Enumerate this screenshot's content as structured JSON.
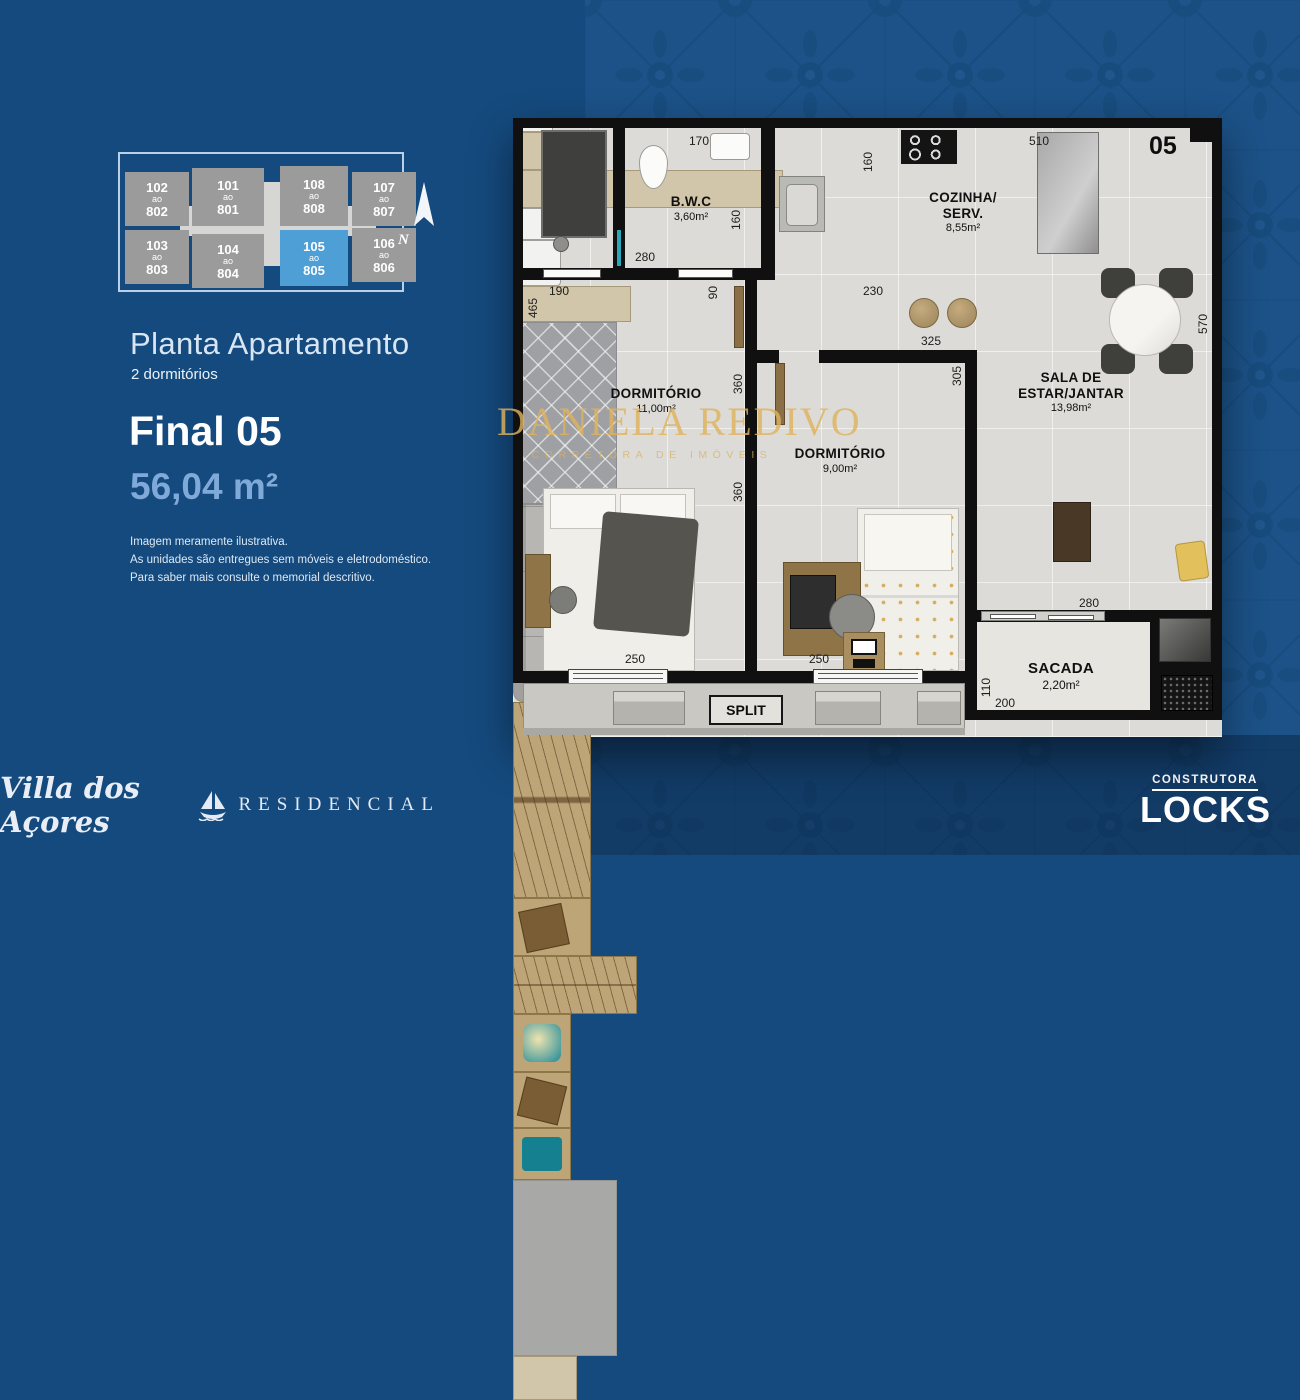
{
  "colors": {
    "left_bg": "#154a7e",
    "pattern_bg": "#1c5288",
    "keyplan_highlight": "#4f9fd7",
    "watermark_gold": "#d9a94e",
    "area_text": "#7fa9d9"
  },
  "left_panel": {
    "keyplan": {
      "units": [
        {
          "top": "102",
          "mid": "ao",
          "bot": "802"
        },
        {
          "top": "101",
          "mid": "ao",
          "bot": "801"
        },
        {
          "top": "108",
          "mid": "ao",
          "bot": "808"
        },
        {
          "top": "107",
          "mid": "ao",
          "bot": "807"
        },
        {
          "top": "103",
          "mid": "ao",
          "bot": "803"
        },
        {
          "top": "104",
          "mid": "ao",
          "bot": "804"
        },
        {
          "top": "105",
          "mid": "ao",
          "bot": "805"
        },
        {
          "top": "106",
          "mid": "ao",
          "bot": "806"
        }
      ],
      "north_label": "N"
    },
    "title": "Planta Apartamento",
    "subtitle": "2 dormitórios",
    "final_label": "Final 05",
    "area_label": "56,04 m²",
    "disclaimer": {
      "line1": "Imagem meramente ilustrativa.",
      "line2": "As unidades são entregues sem móveis e eletrodoméstico.",
      "line3": "Para saber mais consulte o memorial descritivo."
    },
    "brand": {
      "script": "Villa dos Açores",
      "residencial": "RESIDENCIAL"
    }
  },
  "plan": {
    "unit_number": "05",
    "rooms": {
      "bwc": {
        "name": "B.W.C",
        "area": "3,60m²"
      },
      "kitchen": {
        "name1": "COZINHA/",
        "name2": "SERV.",
        "area": "8,55m²"
      },
      "dorm1": {
        "name": "DORMITÓRIO",
        "area": "11,00m²"
      },
      "dorm2": {
        "name": "DORMITÓRIO",
        "area": "9,00m²"
      },
      "sala": {
        "name1": "SALA DE",
        "name2": "ESTAR/JANTAR",
        "area": "13,98m²"
      },
      "sacada": {
        "name": "SACADA",
        "area": "2,20m²"
      }
    },
    "dims": {
      "bwc_top": "170",
      "bwc_right": "160",
      "bwc_bottom": "280",
      "kitchen_left": "160",
      "kitchen_top": "510",
      "kitchen_bottom": "230",
      "dorm1_shelf": "190",
      "dorm1_left": "465",
      "hall": "90",
      "wall_upper": "360",
      "wall_lower": "360",
      "dorm2_top": "325",
      "dorm2_right": "305",
      "sala_right": "570",
      "sofa_bottom": "280",
      "sacada_left": "110",
      "sacada_bottom": "200",
      "dorm1_window": "250",
      "dorm2_window": "250"
    },
    "split": "SPLIT",
    "watermark": {
      "name": "DANIELA REDIVO",
      "tagline": "CORRETORA DE IMÓVEIS"
    }
  },
  "footer": {
    "construtora": "CONSTRUTORA",
    "locks": "LOCKS"
  }
}
